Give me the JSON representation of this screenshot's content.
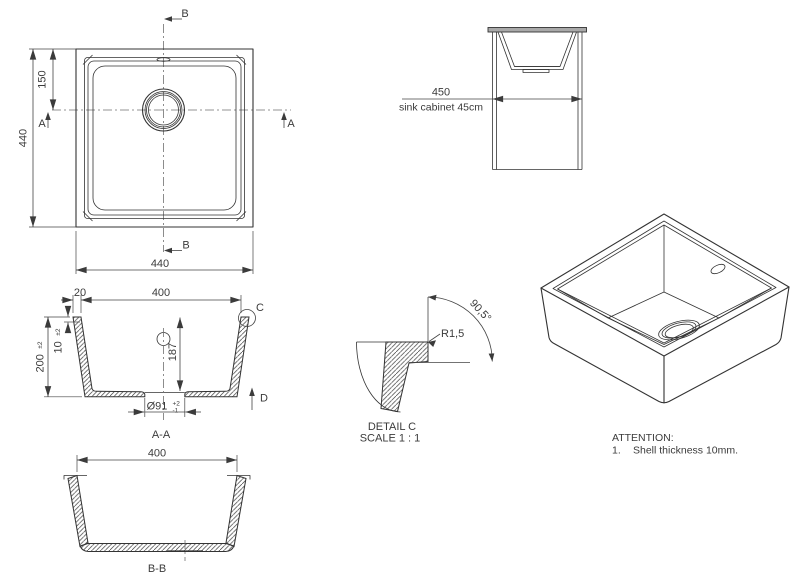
{
  "drawing": {
    "title": "sink technical drawing",
    "top_view": {
      "section_b_label": "B",
      "section_a_label": "A",
      "dim_overall_height": "440",
      "dim_drain_center": "150",
      "dim_overall_width": "440"
    },
    "cabinet_view": {
      "dim_width": "450",
      "caption": "sink cabinet 45cm"
    },
    "section_aa": {
      "dim_rim": "20",
      "dim_opening": "400",
      "dim_height": "200",
      "dim_height_tol": "±2",
      "dim_thickness": "10",
      "dim_thickness_tol": "±2",
      "dim_depth": "187",
      "dim_drain": "Ø91",
      "dim_drain_tol_upper": "+2",
      "dim_drain_tol_lower": "-1",
      "detail_label": "C",
      "arrow_label": "D",
      "caption": "A-A"
    },
    "detail_c": {
      "radius": "R1,5",
      "angle": "90,5°",
      "title": "DETAIL C",
      "scale": "SCALE 1 : 1"
    },
    "section_bb": {
      "dim_opening": "400",
      "caption": "B-B"
    },
    "attention": {
      "title": "ATTENTION:",
      "item_no": "1.",
      "item": "Shell thickness 10mm."
    },
    "colors": {
      "line": "#333333",
      "dimension": "#444444",
      "centerline": "#707070",
      "countertop_fill": "#a9a9a9",
      "background": "#ffffff"
    }
  }
}
